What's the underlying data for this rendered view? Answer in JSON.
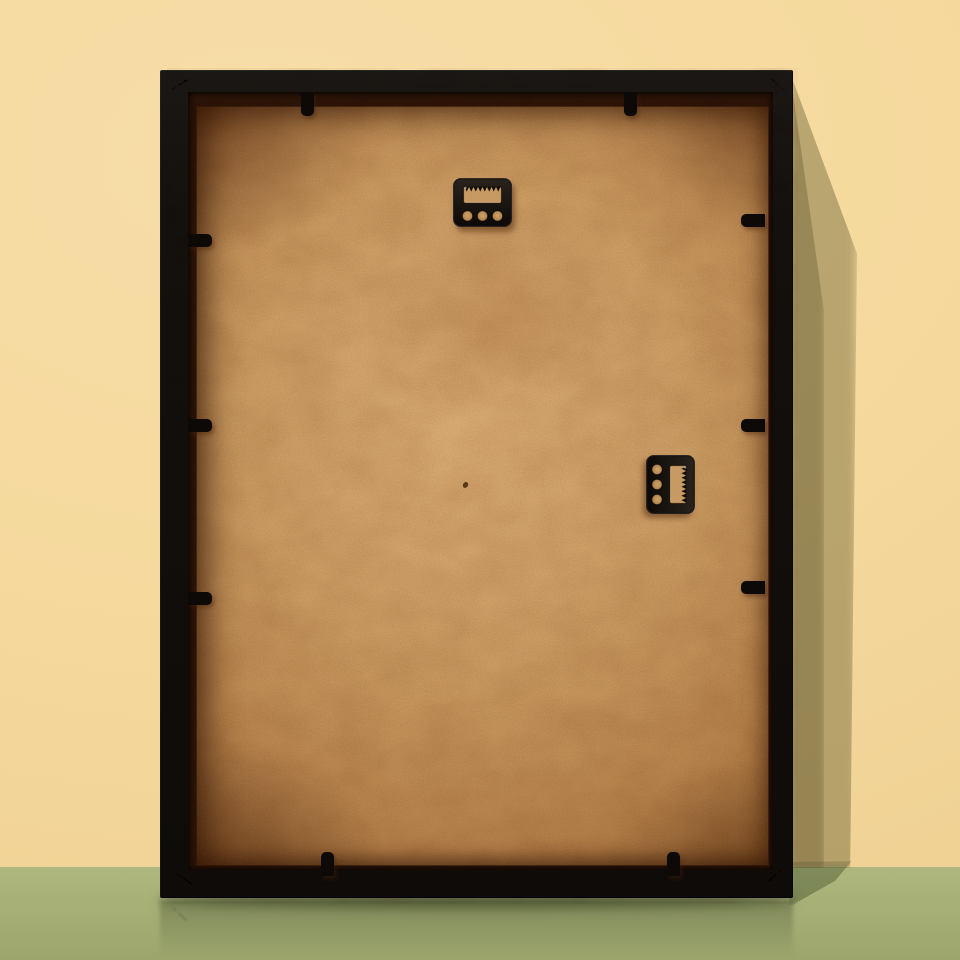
{
  "scene": {
    "title": "Back view of a black picture frame leaning against a pale yellow wall on a sage green floor",
    "wall": {
      "description": "plain pale yellow painted wall"
    },
    "floor": {
      "description": "plain sage green floor with faint reflection of the frame"
    },
    "frame": {
      "description": "black wooden frame seen from the back, leaning against the wall, casting a soft shadow to its right",
      "backing_board": "tan MDF hardboard with speckled fiber texture, darker toward edges, small dark speck near center",
      "hangers": [
        {
          "name": "sawtooth-hanger-top",
          "type": "sawtooth hanger plate",
          "orientation": "horizontal, teeth pointing down",
          "holes": 3,
          "position": "top center of board"
        },
        {
          "name": "sawtooth-hanger-side",
          "type": "sawtooth hanger plate",
          "orientation": "vertical, rotated 90 degrees",
          "holes": 3,
          "position": "middle right of board"
        }
      ],
      "flexi_tab_count": 10,
      "corner_joint_marks": 4
    },
    "tabs": {
      "top": [
        147,
        470
      ],
      "bottom": [
        167,
        513
      ],
      "left": [
        170,
        355,
        528
      ],
      "right": [
        150,
        355,
        517
      ]
    },
    "colors": {
      "wall": "#f5d99d",
      "wall_shadow": "rgba(88,79,35,0.38)",
      "floor": "#a8b278",
      "floor_dark": "#9ba56c",
      "floor_shadow": "rgba(44,54,22,0.35)",
      "frame": "#14100d",
      "frame_sheen": "rgba(255,255,255,0.07)",
      "rabbet": "#2c1307",
      "board_light": "#dcae77",
      "board_mid": "#cfa067",
      "board_dark": "#b8834c",
      "board_edge": "#9a6631",
      "hanger_metal": "#15100b",
      "hanger_hole": "#c79a63",
      "joint_mark": "#d6d1c8",
      "speck": "#46260b",
      "reflection": "rgba(35,42,20,0.30)"
    }
  }
}
